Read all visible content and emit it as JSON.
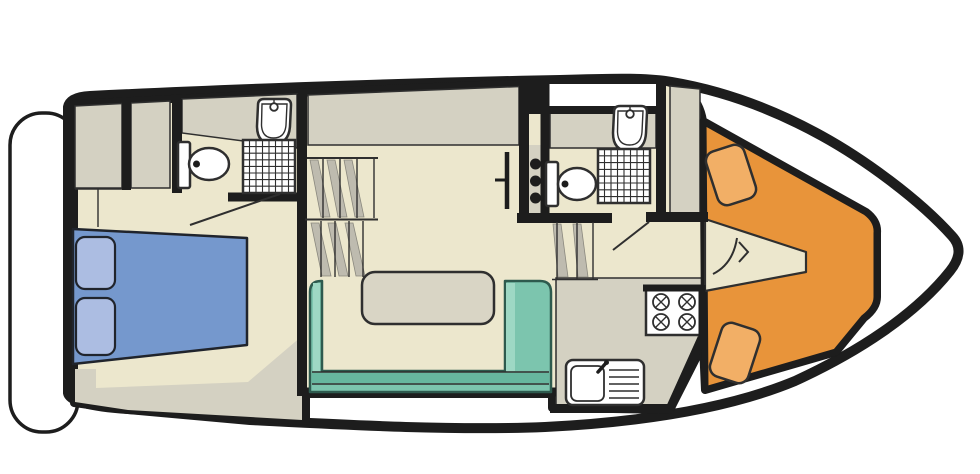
{
  "diagram": {
    "type": "boat-floor-plan",
    "orientation": "bow-right",
    "exterior": {
      "hull_icon": "boat-hull-outline-icon",
      "swim_platform_icon": "stern-platform-icon"
    },
    "rooms": [
      {
        "id": "aft-cabin",
        "label_icon": "double-berth-icon",
        "fixtures": [
          "double-bed",
          "pillow",
          "pillow",
          "wardrobe",
          "wardrobe",
          "shelf",
          "door-swing"
        ],
        "pillow_count": 2
      },
      {
        "id": "aft-bathroom",
        "label_icon": "bathroom-icon",
        "fixtures": [
          "toilet",
          "washbasin",
          "shower-tray",
          "door-swing"
        ]
      },
      {
        "id": "corridor",
        "label_icon": "staircase-icon",
        "fixtures": [
          "stair-flight-upper",
          "stair-flight-lower",
          "folding-door"
        ],
        "stair_flights": 2
      },
      {
        "id": "fore-bathroom",
        "label_icon": "bathroom-icon",
        "fixtures": [
          "toilet",
          "washbasin",
          "shower-tray",
          "skylight-hatch",
          "coat-hooks",
          "companionway-steps",
          "door-swing"
        ],
        "hook_dot_count": 3
      },
      {
        "id": "saloon",
        "label_icon": "sofa-icon",
        "fixtures": [
          "u-shaped-sofa",
          "table"
        ]
      },
      {
        "id": "galley",
        "label_icon": "kitchen-icon",
        "fixtures": [
          "four-burner-hob",
          "sink-with-drainer",
          "worktop"
        ],
        "burner_count": 4
      },
      {
        "id": "bow-cockpit",
        "label_icon": "v-seating-icon",
        "fixtures": [
          "v-shaped-bench",
          "seat-cushion",
          "seat-cushion",
          "door-swing-arc"
        ],
        "cushion_count": 2
      }
    ]
  },
  "colors": {
    "wall": "#1d1d1d",
    "line": "#2f2f2f",
    "floor": "#ece7cd",
    "cabinet": "#d4d1c2",
    "stair-grey": "#bebbaf",
    "teal": "#7cc5ae",
    "teal-dark": "#67b79f",
    "teal-light": "#9ed8c4",
    "teal-line": "#2e5a4e",
    "table": "#d9d5c5",
    "bed": "#7598cd",
    "pillow": "#acbde2",
    "seat-orange": "#e8943a",
    "cushion": "#f2af66"
  }
}
